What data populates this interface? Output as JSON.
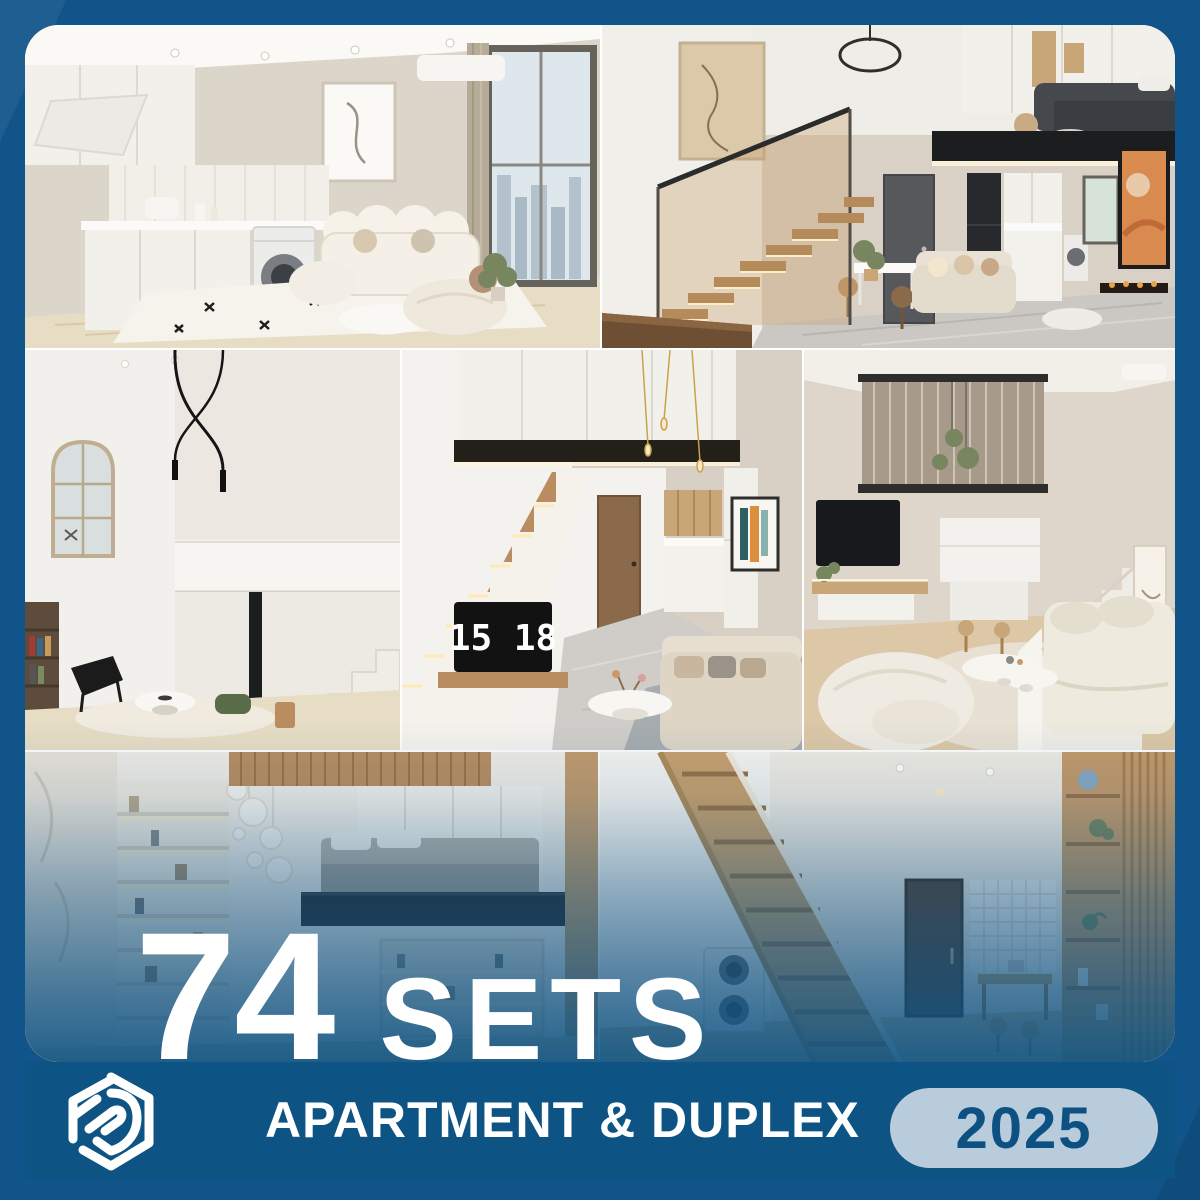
{
  "headline": {
    "number": "74",
    "unit": "SETS"
  },
  "footer": {
    "title": "APARTMENT & DUPLEX",
    "year_badge": "2025",
    "logo": "hexagon-3d-monogram"
  },
  "colors": {
    "frame_blue": "#11548A",
    "bar_blue": "#0D5383",
    "badge_background": "#B9CCDC",
    "badge_text": "#0D5183",
    "overlay_blue": "#105282",
    "headline_text": "#FFFFFF"
  },
  "photo_details": {
    "flip_clock_time": "15 18"
  },
  "photos": [
    {
      "id": "top-left",
      "description": "White kitchen and living room with washing machine, white sofa, rug with black cross pattern and city-view window"
    },
    {
      "id": "top-right",
      "description": "Duplex loft with wooden staircase, glass railing, loft bed, black fridge, kitchen, dining table and fireplace TV wall"
    },
    {
      "id": "middle-left",
      "description": "Tall white duplex room with arched window, curved black pendant lights, mezzanine and black lounge chair"
    },
    {
      "id": "middle-center",
      "description": "Duplex with LED-lit staircase, black flip clock, wood door corridor, kitchen and beige sofa"
    },
    {
      "id": "middle-right",
      "description": "Beige living room with loft glass balustrade, TV wall, kitchen island, staircase and large white sofa"
    },
    {
      "id": "bottom-left",
      "description": "Loft bedroom with backlit shelving, bubble chandelier, wood slat ceiling and platform bed"
    },
    {
      "id": "bottom-right",
      "description": "Entry with wooden staircase, dark door, washer stack, tiled kitchen bar and wooden shelving wall"
    }
  ]
}
